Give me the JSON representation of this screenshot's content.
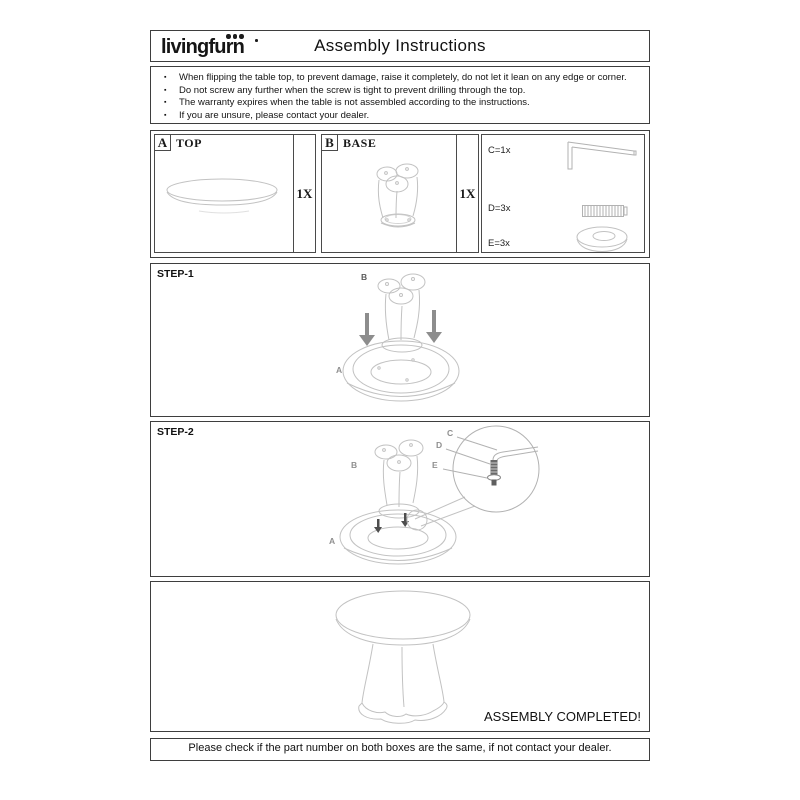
{
  "header": {
    "brand": "livingfurn",
    "title": "Assembly Instructions"
  },
  "warnings": {
    "items": [
      "When flipping the table top, to prevent damage, raise it completely, do not let it lean on any edge or corner.",
      "Do not screw any further when the screw is tight to prevent drilling through the top.",
      "The warranty expires when the table is not assembled according to the instructions.",
      "If you are unsure, please contact your dealer."
    ]
  },
  "parts": {
    "a": {
      "letter": "A",
      "name": "TOP",
      "qty": "1X"
    },
    "b": {
      "letter": "B",
      "name": "BASE",
      "qty": "1X"
    },
    "hardware": [
      {
        "label": "C=1x",
        "icon": "allen-key"
      },
      {
        "label": "D=3x",
        "icon": "screw"
      },
      {
        "label": "E=3x",
        "icon": "washer"
      }
    ]
  },
  "steps": {
    "step1": {
      "label": "STEP-1",
      "callout_a": "A",
      "callout_b": "B"
    },
    "step2": {
      "label": "STEP-2",
      "callout_a": "A",
      "callout_b": "B",
      "callout_c": "C",
      "callout_d": "D",
      "callout_e": "E"
    }
  },
  "completion": {
    "label": "ASSEMBLY COMPLETED!"
  },
  "footer": {
    "text": "Please check if the part number on both boxes are the same, if not contact your dealer."
  },
  "colors": {
    "line_art": "#c2c2c2",
    "border": "#3e3e3e",
    "arrow": "#8d8d8d",
    "text": "#1a1a1a"
  }
}
